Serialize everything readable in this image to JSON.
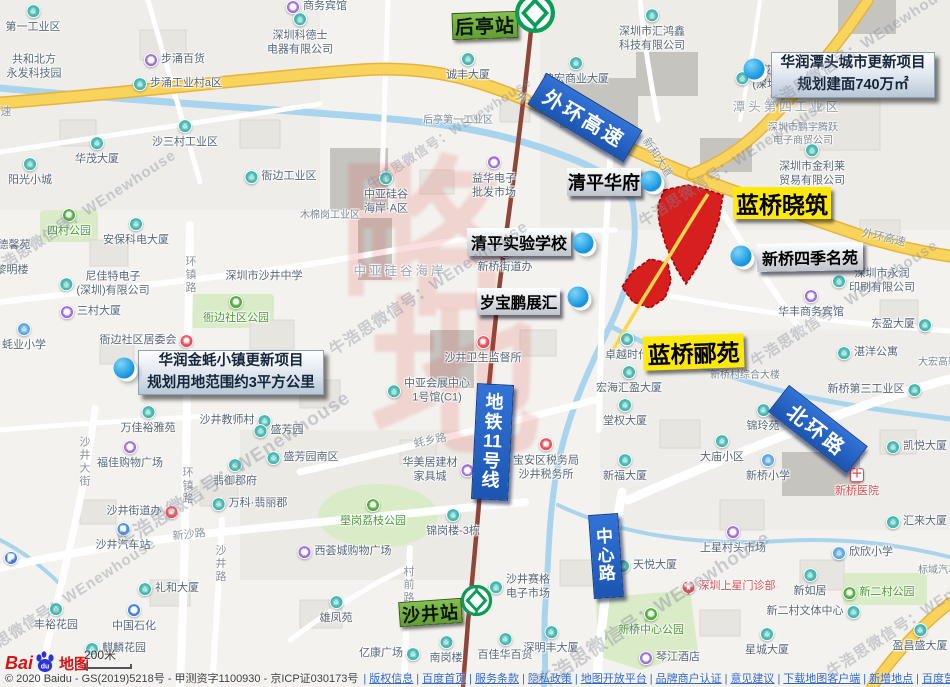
{
  "watermark": {
    "text": "牛浩思微信号：WEnewhouse",
    "spots": [
      {
        "x": -10,
        "y": 262,
        "fs": 15
      },
      {
        "x": 118,
        "y": 530,
        "fs": 19
      },
      {
        "x": 330,
        "y": 338,
        "fs": 16
      },
      {
        "x": 368,
        "y": 175,
        "fs": 13
      },
      {
        "x": 640,
        "y": 212,
        "fs": 15
      },
      {
        "x": 768,
        "y": 95,
        "fs": 15
      },
      {
        "x": 752,
        "y": 352,
        "fs": 15
      },
      {
        "x": 538,
        "y": 670,
        "fs": 19
      },
      {
        "x": -30,
        "y": 650,
        "fs": 15
      },
      {
        "x": 828,
        "y": 662,
        "fs": 15
      }
    ],
    "big": {
      "chars": [
        "略",
        "地"
      ],
      "x": 338,
      "y": 160,
      "fs": 172
    }
  },
  "stations": [
    {
      "label": "后亭站",
      "x": 452,
      "y": 12,
      "w": 66,
      "h": 27,
      "rot": -2,
      "fs": 19,
      "logo": {
        "x": 514,
        "y": -8,
        "s": 42
      }
    },
    {
      "label": "沙井站",
      "x": 399,
      "y": 600,
      "w": 63,
      "h": 25,
      "rot": -4,
      "fs": 18,
      "logo": {
        "x": 460,
        "y": 584,
        "s": 33
      }
    }
  ],
  "road_badges": [
    {
      "label": "外环高速",
      "x": 529,
      "y": 99,
      "w": 112,
      "h": 37,
      "rot": 31,
      "fs": 20,
      "vertical": false
    },
    {
      "label": "地铁11号线",
      "x": 474,
      "y": 384,
      "w": 37,
      "h": 116,
      "rot": 3,
      "fs": 18,
      "vertical": true,
      "segs": [
        "地",
        "铁",
        "11",
        "号",
        "线"
      ]
    },
    {
      "label": "中心路",
      "x": 591,
      "y": 514,
      "w": 30,
      "h": 84,
      "rot": -4,
      "fs": 17,
      "vertical": true,
      "segs": [
        "中",
        "心",
        "路"
      ]
    },
    {
      "label": "北环路",
      "x": 768,
      "y": 412,
      "w": 100,
      "h": 34,
      "rot": 38,
      "fs": 20,
      "vertical": false
    }
  ],
  "estate_labels": [
    {
      "label": "蓝桥晓筑",
      "style": "yellow",
      "x": 733,
      "y": 187,
      "w": 98,
      "h": 32,
      "rot": 0,
      "fs": 23
    },
    {
      "label": "蓝桥郦苑",
      "style": "yellow",
      "x": 643,
      "y": 335,
      "w": 101,
      "h": 34,
      "rot": -2,
      "fs": 23
    },
    {
      "label": "清平华府",
      "style": "silver",
      "x": 567,
      "y": 168,
      "w": 74,
      "h": 28,
      "rot": 0,
      "fs": 18
    },
    {
      "label": "清平实验学校",
      "style": "silver",
      "x": 467,
      "y": 228,
      "w": 104,
      "h": 28,
      "rot": 0,
      "fs": 16
    },
    {
      "label": "岁宝鹏展汇",
      "style": "silver",
      "x": 477,
      "y": 288,
      "w": 83,
      "h": 27,
      "rot": 0,
      "fs": 15.5
    },
    {
      "label": "新桥四季名苑",
      "style": "silver",
      "x": 757,
      "y": 243,
      "w": 106,
      "h": 28,
      "rot": -1,
      "fs": 16
    }
  ],
  "project_boxes": [
    {
      "lines": [
        "华润潭头城市更新项目",
        "规划建面740万㎡"
      ],
      "x": 771,
      "y": 52,
      "w": 164,
      "h": 46
    },
    {
      "lines": [
        "华润金蚝小镇更新项目",
        "规划用地范围约3平方公里"
      ],
      "x": 138,
      "y": 350,
      "w": 186,
      "h": 45
    }
  ],
  "marker_dots": [
    {
      "x": 754,
      "y": 69
    },
    {
      "x": 651,
      "y": 181
    },
    {
      "x": 583,
      "y": 243
    },
    {
      "x": 578,
      "y": 297
    },
    {
      "x": 741,
      "y": 256
    },
    {
      "x": 124,
      "y": 368
    }
  ],
  "road_labels": [
    {
      "t": "外环",
      "x": 527,
      "y": 100,
      "r": 28
    },
    {
      "t": "外环高速",
      "x": 884,
      "y": 237,
      "r": 13
    },
    {
      "t": "新和大道",
      "x": 658,
      "y": 157,
      "r": 57
    },
    {
      "t": "蚝乡路",
      "x": 430,
      "y": 440,
      "r": -12
    },
    {
      "t": "新沙路",
      "x": 189,
      "y": 534,
      "r": -6
    },
    {
      "t": "环镇路",
      "x": 190,
      "y": 275,
      "v": 1
    },
    {
      "t": "环镇路",
      "x": 187,
      "y": 486,
      "v": 1
    },
    {
      "t": "沙井大街",
      "x": 84,
      "y": 462,
      "v": 1
    },
    {
      "t": "沙井路",
      "x": 220,
      "y": 564,
      "v": 1
    },
    {
      "t": "村前路",
      "x": 408,
      "y": 585,
      "v": 1
    },
    {
      "t": "速",
      "x": 6,
      "y": 111
    }
  ],
  "pois": [
    {
      "t": "商务宾馆",
      "x": 325,
      "y": 7,
      "i": "shop",
      "p": "left"
    },
    {
      "t": "第一工业区",
      "x": 33,
      "y": 28,
      "i": "building",
      "p": "above"
    },
    {
      "t": "深圳科德士\n电器有限公司",
      "x": 300,
      "y": 43,
      "i": "building",
      "p": "above"
    },
    {
      "t": "深圳市汇鸿鑫\n科技有限公司",
      "x": 652,
      "y": 39,
      "i": "building",
      "p": "above"
    },
    {
      "t": "共和北方\n永发科技园",
      "x": 34,
      "y": 67
    },
    {
      "t": "诚丰大厦",
      "x": 468,
      "y": 76,
      "i": "building",
      "p": "above"
    },
    {
      "t": "坤宏商业大厦",
      "x": 576,
      "y": 80,
      "i": "building",
      "p": "above"
    },
    {
      "t": "艾德盛科技\n(深圳)有限公司",
      "x": 789,
      "y": 78,
      "i": "building",
      "p": "left"
    },
    {
      "t": "步涌百货",
      "x": 183,
      "y": 60,
      "i": "shop",
      "p": "left"
    },
    {
      "t": "步涌工业村a区",
      "x": 186,
      "y": 84,
      "i": "building",
      "p": "left"
    },
    {
      "t": "后亭第一工业区",
      "x": 458,
      "y": 121,
      "c": "sm"
    },
    {
      "t": "潭头第四工业区",
      "x": 787,
      "y": 108,
      "c": "area"
    },
    {
      "t": "深圳市鹏宇腾跃\n电子商贸公司",
      "x": 803,
      "y": 135,
      "c": "sm"
    },
    {
      "t": "深圳市金利莱\n贸易有限公司",
      "x": 812,
      "y": 174,
      "i": "building",
      "p": "above"
    },
    {
      "t": "华茂大厦",
      "x": 97,
      "y": 160,
      "i": "building",
      "p": "above"
    },
    {
      "t": "阳光小城",
      "x": 30,
      "y": 181,
      "i": "building",
      "p": "above"
    },
    {
      "t": "沙三村工业区",
      "x": 185,
      "y": 143,
      "i": "building",
      "p": "above"
    },
    {
      "t": "衙边工业区",
      "x": 289,
      "y": 177,
      "i": "building",
      "p": "left"
    },
    {
      "t": "益华电子\n批发市场",
      "x": 494,
      "y": 186,
      "i": "shop",
      "p": "above"
    },
    {
      "t": "中亚硅谷\n海岸·A区",
      "x": 386,
      "y": 202,
      "i": "building",
      "p": "above"
    },
    {
      "t": "中亚硅谷海岸",
      "x": 400,
      "y": 272,
      "c": "area"
    },
    {
      "t": "木棉岗工业区",
      "x": 330,
      "y": 216,
      "c": "sm"
    },
    {
      "t": "四村公园",
      "x": 69,
      "y": 232,
      "i": "park",
      "p": "above",
      "c": "park"
    },
    {
      "t": "安保科电大厦",
      "x": 136,
      "y": 241,
      "i": "building",
      "p": "above"
    },
    {
      "t": "德馨苑",
      "x": 14,
      "y": 246
    },
    {
      "t": "黎明楼",
      "x": 12,
      "y": 271
    },
    {
      "t": "尼佳特电子\n(深圳)有限公司",
      "x": 113,
      "y": 284,
      "i": "building",
      "p": "left"
    },
    {
      "t": "三村大厦",
      "x": 99,
      "y": 312,
      "i": "shop",
      "p": "left"
    },
    {
      "t": "蚝业小学",
      "x": 24,
      "y": 346,
      "i": "school",
      "p": "above"
    },
    {
      "t": "深圳市沙井中学",
      "x": 264,
      "y": 277
    },
    {
      "t": "衙边社区公园",
      "x": 236,
      "y": 319,
      "i": "park",
      "p": "above",
      "c": "park"
    },
    {
      "t": "衙边社区居委会",
      "x": 138,
      "y": 341,
      "i": "star",
      "p": "right"
    },
    {
      "t": "新桥街道办",
      "x": 505,
      "y": 268,
      "i": "star",
      "p": "above"
    },
    {
      "t": "沙井卫生监督所",
      "x": 483,
      "y": 359,
      "i": "star",
      "p": "above"
    },
    {
      "t": "中亚会展中心\n1号馆(C1)",
      "x": 437,
      "y": 391,
      "i": "building",
      "p": "left"
    },
    {
      "t": "卓越时代",
      "x": 627,
      "y": 356,
      "i": "building",
      "p": "above"
    },
    {
      "t": "宏海汇盈大厦",
      "x": 629,
      "y": 389,
      "i": "building",
      "p": "above"
    },
    {
      "t": "堂权大厦",
      "x": 625,
      "y": 422,
      "i": "building",
      "p": "above"
    },
    {
      "t": "新福大厦",
      "x": 625,
      "y": 477,
      "i": "building",
      "p": "above"
    },
    {
      "t": "新桥村综合大楼",
      "x": 745,
      "y": 376,
      "c": "sm"
    },
    {
      "t": "锦玲苑",
      "x": 763,
      "y": 427,
      "i": "building",
      "p": "above"
    },
    {
      "t": "大庙小区",
      "x": 722,
      "y": 458,
      "i": "building",
      "p": "above"
    },
    {
      "t": "新桥小学",
      "x": 768,
      "y": 477,
      "i": "school",
      "p": "above"
    },
    {
      "t": "新桥医院",
      "x": 857,
      "y": 492,
      "i": "hospital",
      "p": "above",
      "c": "red"
    },
    {
      "t": "湛洋公寓",
      "x": 876,
      "y": 353,
      "i": "building",
      "p": "left"
    },
    {
      "t": "新桥第三工业区",
      "x": 866,
      "y": 390,
      "i": "building",
      "p": "right"
    },
    {
      "t": "东盈大厦",
      "x": 893,
      "y": 325,
      "i": "building",
      "p": "right"
    },
    {
      "t": "深圳市永润\n印刷有限公司",
      "x": 882,
      "y": 281,
      "i": "building",
      "p": "left"
    },
    {
      "t": "华丰商务宾馆",
      "x": 811,
      "y": 313,
      "i": "shop",
      "p": "above"
    },
    {
      "t": "大宏高新",
      "x": 938,
      "y": 363,
      "c": "sm"
    },
    {
      "t": "凯悦大厦",
      "x": 925,
      "y": 447,
      "i": "building",
      "p": "left"
    },
    {
      "t": "万佳裕雅苑",
      "x": 148,
      "y": 429,
      "i": "building",
      "p": "above"
    },
    {
      "t": "福佳购物广场",
      "x": 130,
      "y": 464,
      "i": "shop",
      "p": "above"
    },
    {
      "t": "沙井教师村",
      "x": 227,
      "y": 421,
      "i": "building",
      "p": "right"
    },
    {
      "t": "盛芳园",
      "x": 287,
      "y": 431,
      "i": "building",
      "p": "left"
    },
    {
      "t": "盛芳园南区",
      "x": 311,
      "y": 458,
      "i": "building",
      "p": "left"
    },
    {
      "t": "翡御郡府",
      "x": 235,
      "y": 482,
      "i": "building",
      "p": "above"
    },
    {
      "t": "万科·翡丽郡",
      "x": 258,
      "y": 504,
      "i": "building",
      "p": "left"
    },
    {
      "t": "壆岗荔枝公园",
      "x": 373,
      "y": 522,
      "i": "park",
      "p": "above",
      "c": "park"
    },
    {
      "t": "西荟城购物广场",
      "x": 353,
      "y": 552,
      "i": "shop",
      "p": "left"
    },
    {
      "t": "华美居建材\n家具城",
      "x": 430,
      "y": 470,
      "i": "shop",
      "p": "right"
    },
    {
      "t": "锦岗楼-3栋",
      "x": 453,
      "y": 532,
      "i": "building",
      "p": "above"
    },
    {
      "t": "雄凤苑",
      "x": 336,
      "y": 619,
      "i": "building",
      "p": "above"
    },
    {
      "t": "沙井街道办",
      "x": 134,
      "y": 512,
      "i": "star",
      "p": "right"
    },
    {
      "t": "沙井汽车站",
      "x": 123,
      "y": 546,
      "i": "bus",
      "p": "above"
    },
    {
      "t": "礼和大厦",
      "x": 177,
      "y": 589,
      "i": "building",
      "p": "left"
    },
    {
      "t": "中国石化",
      "x": 134,
      "y": 627,
      "i": "gas",
      "p": "above"
    },
    {
      "t": "丰裕花园",
      "x": 56,
      "y": 626,
      "i": "building",
      "p": "above"
    },
    {
      "t": "麒麟花园",
      "x": 124,
      "y": 649,
      "i": "building",
      "p": "left"
    },
    {
      "t": "亿康广场",
      "x": 381,
      "y": 654,
      "i": "building",
      "p": "right"
    },
    {
      "t": "南岗楼",
      "x": 446,
      "y": 659,
      "i": "building",
      "p": "above"
    },
    {
      "t": "百佳华百货",
      "x": 505,
      "y": 656,
      "i": "building",
      "p": "above"
    },
    {
      "t": "深明丰大厦",
      "x": 551,
      "y": 649,
      "i": "building",
      "p": "above"
    },
    {
      "t": "沙井赛格\n电子市场",
      "x": 528,
      "y": 587,
      "i": "building",
      "p": "left"
    },
    {
      "t": "宝安区税务局\n沙井税务所",
      "x": 546,
      "y": 468,
      "i": "star",
      "p": "above"
    },
    {
      "t": "上星村头市场",
      "x": 733,
      "y": 549,
      "i": "shop",
      "p": "above"
    },
    {
      "t": "深圳上星门诊部",
      "x": 737,
      "y": 587,
      "i": "pin",
      "p": "left",
      "c": "red"
    },
    {
      "t": "天悦大厦",
      "x": 655,
      "y": 566,
      "i": "building",
      "p": "left"
    },
    {
      "t": "新桥中心公园",
      "x": 651,
      "y": 631,
      "i": "park",
      "p": "above",
      "c": "park"
    },
    {
      "t": "琴江酒店",
      "x": 678,
      "y": 658,
      "i": "shop",
      "p": "left"
    },
    {
      "t": "星城大厦",
      "x": 767,
      "y": 651,
      "i": "building",
      "p": "above"
    },
    {
      "t": "新如居",
      "x": 810,
      "y": 592,
      "i": "building",
      "p": "above"
    },
    {
      "t": "新二村文体中心",
      "x": 805,
      "y": 612,
      "i": "building",
      "p": "right"
    },
    {
      "t": "新二村公园",
      "x": 887,
      "y": 593,
      "i": "park",
      "p": "left",
      "c": "park"
    },
    {
      "t": "欣欣小学",
      "x": 871,
      "y": 553,
      "i": "school",
      "p": "left"
    },
    {
      "t": "汇来大厦",
      "x": 925,
      "y": 522,
      "i": "building",
      "p": "left"
    },
    {
      "t": "标域汽车",
      "x": 938,
      "y": 571,
      "c": "sm"
    },
    {
      "t": "盈昌盛大厦",
      "x": 920,
      "y": 647,
      "i": "building",
      "p": "above"
    },
    {
      "t": "",
      "x": 11,
      "y": 558,
      "i": "parking"
    }
  ],
  "logo": {
    "word_a": "Bai",
    "word_b": "du",
    "word_c": "地图"
  },
  "scale": {
    "label": "200米"
  },
  "attribution": {
    "copyright": "© 2020 Baidu - GS(2019)5218号 - 甲测资字1100930 - 京ICP证030173号",
    "links": [
      "版权信息",
      "百度首页",
      "服务条款",
      "隐私政策",
      "地图开放平台",
      "品牌商户认证",
      "意见建议",
      "下载地图客户端",
      "新增地点",
      "百度营销"
    ]
  }
}
